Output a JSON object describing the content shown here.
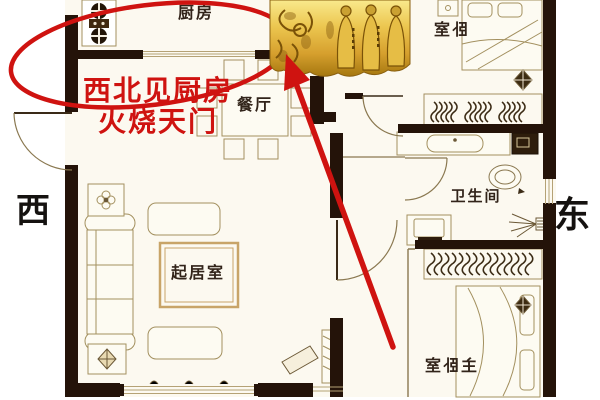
{
  "rooms": [
    {
      "id": "kitchen",
      "label": "厨房",
      "mirrored": false
    },
    {
      "id": "dining",
      "label": "餐厅",
      "mirrored": false
    },
    {
      "id": "bedroom",
      "label": "卧室",
      "mirrored": true
    },
    {
      "id": "bathroom",
      "label": "卫生间",
      "mirrored": false
    },
    {
      "id": "living-room",
      "label": "起居室",
      "mirrored": false
    },
    {
      "id": "master-bedroom",
      "label": "主卧室",
      "mirrored": true
    }
  ],
  "compass": {
    "west": "西",
    "east": "东"
  },
  "annotation": {
    "line1": "西北见厨房",
    "line2": "火烧天门",
    "color": "#cf1310",
    "shapes": [
      "highlight-ellipse-around-kitchen",
      "arrow-pointing-to-kitchen"
    ]
  },
  "colors": {
    "annotation_red": "#cf1310",
    "wall": "#241309",
    "floor": "#fcf9f0",
    "furniture_line": "#a3905f",
    "gold_plaque": "#d9a832",
    "label_text": "#32241a"
  },
  "icons": [
    "stove-icon",
    "dining-table-icon",
    "chair-icon",
    "sofa-icon",
    "flower-table-icon",
    "star-table-icon",
    "rug-icon",
    "tv-icon",
    "tv-cabinet-icon",
    "bed-icon",
    "nightstand-icon",
    "wardrobe-hangers-icon",
    "sink-vanity-icon",
    "washer-icon",
    "toilet-icon",
    "shower-icon",
    "ceiling-lamp-icon",
    "desk-laptop-icon",
    "door-arc-icon",
    "window-icon",
    "golden-deity-plaque",
    "highlight-ellipse",
    "arrow-annotation"
  ]
}
